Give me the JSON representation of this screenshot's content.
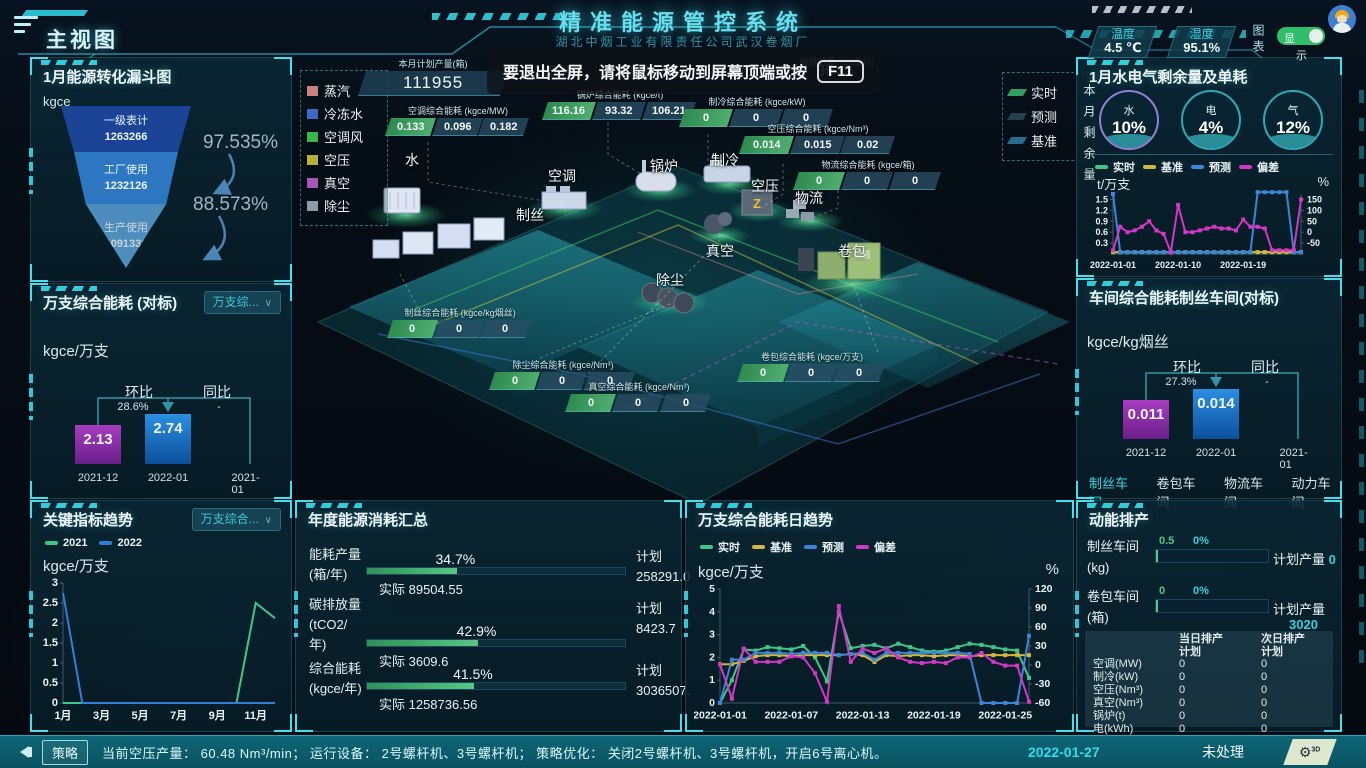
{
  "header": {
    "view_title": "主视图",
    "app_title": "精准能源管控系统",
    "app_subtitle": "湖北中烟工业有限责任公司武汉卷烟厂",
    "temperature_label": "温度",
    "temperature_value": "4.5 ℃",
    "humidity_label": "湿度",
    "humidity_value": "95.1%",
    "chart_vertical_label": "图表",
    "display_toggle_on": "显",
    "display_toggle_off": "示"
  },
  "toast": {
    "message": "要退出全屏，请将鼠标移动到屏幕顶端或按",
    "key": "F11"
  },
  "kpi_band": {
    "plan_label": "本月计划产量(箱)",
    "plan_value": "111955",
    "dim_values": [
      "110961",
      "0.886 %",
      "2.305",
      "3642"
    ],
    "dim_label": "碳排放量(tCO2/月)"
  },
  "scene": {
    "flow_legend": [
      {
        "label": "蒸汽",
        "color": "#c98080"
      },
      {
        "label": "冷冻水",
        "color": "#3f68c9"
      },
      {
        "label": "空调风",
        "color": "#3ab54e"
      },
      {
        "label": "空压",
        "color": "#b8b03a"
      },
      {
        "label": "真空",
        "color": "#a855b8"
      },
      {
        "label": "除尘",
        "color": "#8c9aa8"
      }
    ],
    "series_legend": [
      {
        "label": "实时",
        "color": "#2f9e5f"
      },
      {
        "label": "预测",
        "color": "#24404f"
      },
      {
        "label": "基准",
        "color": "#2a6a8a"
      }
    ],
    "nodes": [
      "水",
      "空调",
      "制丝",
      "锅炉",
      "制冷",
      "空压",
      "物流",
      "真空",
      "除尘",
      "卷包"
    ],
    "strips": [
      {
        "label": "空调综合能耗 (kgce/MW)",
        "values": [
          "0.133",
          "0.096",
          "0.182"
        ]
      },
      {
        "label": "锅炉综合能耗 (kgce/t)",
        "values": [
          "116.16",
          "93.32",
          "106.21"
        ]
      },
      {
        "label": "制冷综合能耗 (kgce/kW)",
        "values": [
          "0",
          "0",
          "0"
        ]
      },
      {
        "label": "空压综合能耗 (kgce/Nm³)",
        "values": [
          "0.014",
          "0.015",
          "0.02"
        ]
      },
      {
        "label": "物流综合能耗 (kgce/箱)",
        "values": [
          "0",
          "0",
          "0"
        ]
      },
      {
        "label": "制丝综合能耗 (kgce/kg烟丝)",
        "values": [
          "0",
          "0",
          "0"
        ]
      },
      {
        "label": "除尘综合能耗 (kgce/Nm³)",
        "values": [
          "0",
          "0",
          "0"
        ]
      },
      {
        "label": "真空综合能耗 (kgce/Nm³)",
        "values": [
          "0",
          "0",
          "0"
        ]
      },
      {
        "label": "卷包综合能耗 (kgce/万支)",
        "values": [
          "0",
          "0",
          "0"
        ]
      }
    ]
  },
  "funnel_panel": {
    "title": "1月能源转化漏斗图",
    "unit": "kgce"
  },
  "wan_panel": {
    "title": "万支综合能耗 (对标)",
    "dropdown": "万支综...",
    "unit": "kgce/万支"
  },
  "trend_panel": {
    "title": "关键指标趋势",
    "dropdown": "万支综合...",
    "unit": "kgce/万支"
  },
  "annual_panel": {
    "title": "年度能源消耗汇总",
    "actual_prefix": "实际",
    "plan_label": "计划",
    "rows": [
      {
        "label_lines": [
          "能耗产量",
          "(箱/年)"
        ],
        "percent": "34.7%",
        "pct": 34.7,
        "actual": "89504.55",
        "plan": "258291.0"
      },
      {
        "label_lines": [
          "碳排放量",
          "(tCO2/",
          "年)"
        ],
        "percent": "42.9%",
        "pct": 42.9,
        "actual": "3609.6",
        "plan": "8423.7"
      },
      {
        "label_lines": [
          "综合能耗",
          "(kgce/年)"
        ],
        "percent": "41.5%",
        "pct": 41.5,
        "actual": "1258736.56",
        "plan": "3036507."
      }
    ]
  },
  "daily_panel": {
    "title": "万支综合能耗日趋势",
    "unit_left": "kgce/万支",
    "unit_right": "%"
  },
  "water_panel": {
    "title": "1月水电气剩余量及单耗",
    "side_label": "本月剩余量",
    "unit_left": "t/万支",
    "unit_right": "%",
    "donuts": [
      {
        "name": "水",
        "pct": "10%",
        "ring": "#8f7fd8"
      },
      {
        "name": "电",
        "pct": "4%",
        "ring": "#2fa8b8"
      },
      {
        "name": "气",
        "pct": "12%",
        "ring": "#2fa8b8"
      }
    ]
  },
  "workshop_panel": {
    "title": "车间综合能耗制丝车间(对标)",
    "unit": "kgce/kg烟丝",
    "tabs": [
      {
        "label": "制丝车间",
        "active": true
      },
      {
        "label": "卷包车间",
        "active": false
      },
      {
        "label": "物流车间",
        "active": false
      },
      {
        "label": "动力车间",
        "active": false
      }
    ]
  },
  "schedule_panel": {
    "title": "动能排产",
    "plan_output_label": "计划产量",
    "rows": [
      {
        "label": "制丝车间",
        "unit": "(kg)",
        "value": "0.5",
        "percent": "0%",
        "plan": "0",
        "plan_inline": true
      },
      {
        "label": "卷包车间",
        "unit": "(箱)",
        "value": "0",
        "percent": "0%",
        "plan": "3020",
        "plan_inline": false
      }
    ],
    "table": {
      "col1": "当日排产",
      "col2": "次日排产",
      "col_sub": "计划",
      "rows": [
        [
          "空调(MW)",
          "0",
          "0"
        ],
        [
          "制冷(kW)",
          "0",
          "0"
        ],
        [
          "空压(Nm³)",
          "0",
          "0"
        ],
        [
          "真空(Nm³)",
          "0",
          "0"
        ],
        [
          "锅炉(t)",
          "0",
          "0"
        ],
        [
          "电(kWh)",
          "0",
          "0"
        ]
      ]
    }
  },
  "status_bar": {
    "badge": "策略",
    "text": "当前空压产量： 60.48 Nm³/min； 运行设备： 2号螺杆机、3号螺杆机； 策略优化： 关闭2号螺杆机、3号螺杆机，开启6号离心机。",
    "date": "2022-01-27",
    "state": "未处理"
  },
  "chart_data": [
    {
      "id": "funnel",
      "type": "funnel",
      "title": "1月能源转化漏斗图",
      "unit": "kgce",
      "stages": [
        {
          "label": "一级表计",
          "value": 1263266,
          "color": "#1c4496"
        },
        {
          "label": "工厂使用",
          "value": 1232126,
          "color": "#2d77c2"
        },
        {
          "label": "生产使用",
          "value": 1091331,
          "color": "#5aa2d8"
        }
      ],
      "conversion_rates": [
        "97.535%",
        "88.573%"
      ]
    },
    {
      "id": "wan-benchmark",
      "type": "bar",
      "unit": "kgce/万支",
      "categories": [
        "2021-12",
        "2022-01",
        "2021-01"
      ],
      "values": [
        2.13,
        2.74,
        null
      ],
      "mom_label": "环比",
      "mom": "28.6%",
      "yoy_label": "同比",
      "yoy": "-",
      "bar_colors": [
        "linear-gradient(180deg,#a73cc2,#6b1f8a)",
        "linear-gradient(180deg,#2b8fe0,#0c4f9c)"
      ]
    },
    {
      "id": "key-trend",
      "type": "line",
      "unit": "kgce/万支",
      "x": [
        "1月",
        "2月",
        "3月",
        "4月",
        "5月",
        "6月",
        "7月",
        "8月",
        "9月",
        "10月",
        "11月",
        "12月"
      ],
      "ylim": [
        0,
        3
      ],
      "yticks": [
        0,
        0.5,
        1,
        1.5,
        2,
        2.5,
        3
      ],
      "xtick_idx": [
        0,
        2,
        4,
        6,
        8,
        10
      ],
      "series": [
        {
          "name": "2021",
          "color": "#3ec787",
          "values": [
            0,
            0,
            0,
            0,
            0,
            0,
            0,
            0,
            0,
            0,
            2.5,
            2.12
          ]
        },
        {
          "name": "2022",
          "color": "#2f7fd9",
          "values": [
            2.75,
            0,
            0,
            0,
            0,
            0,
            0,
            0,
            0,
            0,
            0,
            0
          ]
        }
      ]
    },
    {
      "id": "water-daily",
      "type": "line",
      "unit_left": "t/万支",
      "unit_right": "%",
      "ylim": [
        0,
        1.65
      ],
      "yticks": [
        0.3,
        0.6,
        0.9,
        1.2,
        1.5
      ],
      "y2lim": [
        -100,
        175
      ],
      "y2ticks": [
        -50,
        0,
        50,
        100,
        150
      ],
      "xticks": [
        {
          "i": 0,
          "label": "2022-01-01"
        },
        {
          "i": 9,
          "label": "2022-01-10"
        },
        {
          "i": 18,
          "label": "2022-01-19"
        }
      ],
      "series": [
        {
          "name": "实时",
          "color": "#3ec787",
          "axis": 1,
          "values": [
            0.05,
            0.05,
            0.05,
            0.05,
            0.05,
            0.05,
            0.05,
            0.05,
            0.05,
            0.05,
            0.05,
            0.05,
            0.05,
            0.05,
            0.05,
            0.05,
            0.05,
            0.05,
            0.05,
            0.05,
            0.05,
            0.05,
            0.05,
            0.05,
            0.05,
            0.05,
            0.05
          ]
        },
        {
          "name": "基准",
          "color": "#d4b83a",
          "axis": 1,
          "values": [
            0.05,
            0.05,
            0.05,
            0.05,
            0.05,
            0.05,
            0.05,
            0.05,
            0.05,
            0.05,
            0.05,
            0.05,
            0.05,
            0.05,
            0.05,
            0.05,
            0.05,
            0.05,
            0.05,
            0.05,
            0.05,
            0.05,
            0.05,
            0.05,
            0.05,
            0.05,
            0.05
          ]
        },
        {
          "name": "预测",
          "color": "#3a86d9",
          "axis": 1,
          "values": [
            1.65,
            0.05,
            0.05,
            0.05,
            0.05,
            0.05,
            0.05,
            0.05,
            0.05,
            0.05,
            0.05,
            0.05,
            0.05,
            0.05,
            0.05,
            0.05,
            0.05,
            0.05,
            0.05,
            0.05,
            1.7,
            1.7,
            1.7,
            1.7,
            1.7,
            0.05,
            0.05
          ]
        },
        {
          "name": "偏差",
          "color": "#d337c5",
          "axis": 2,
          "values": [
            -83,
            25,
            0,
            8,
            25,
            50,
            8,
            -8,
            -92,
            125,
            0,
            0,
            8,
            17,
            25,
            17,
            17,
            8,
            58,
            25,
            25,
            17,
            -83,
            -83,
            -83,
            -83,
            150
          ]
        }
      ]
    },
    {
      "id": "wan-daily",
      "type": "line",
      "unit_left": "kgce/万支",
      "unit_right": "%",
      "ylim": [
        0,
        5
      ],
      "yticks": [
        0,
        1,
        2,
        3,
        4,
        5
      ],
      "y2lim": [
        -60,
        120
      ],
      "y2ticks": [
        -60,
        -30,
        0,
        30,
        60,
        90,
        120
      ],
      "xticks": [
        {
          "i": 0,
          "label": "2022-01-01"
        },
        {
          "i": 6,
          "label": "2022-01-07"
        },
        {
          "i": 12,
          "label": "2022-01-13"
        },
        {
          "i": 18,
          "label": "2022-01-19"
        },
        {
          "i": 24,
          "label": "2022-01-25"
        }
      ],
      "series": [
        {
          "name": "实时",
          "color": "#3ec787",
          "axis": 1,
          "values": [
            0,
            1.0,
            2.35,
            2.3,
            2.45,
            2.4,
            2.35,
            2.5,
            2.0,
            0.95,
            4.0,
            2.4,
            2.5,
            2.55,
            2.4,
            2.6,
            2.45,
            2.3,
            2.25,
            2.3,
            2.45,
            2.6,
            2.55,
            2.45,
            2.35,
            2.3,
            1.1
          ]
        },
        {
          "name": "基准",
          "color": "#d4b83a",
          "axis": 1,
          "values": [
            1.7,
            1.7,
            1.85,
            2.05,
            2.1,
            2.1,
            2.05,
            2.1,
            2.1,
            2.1,
            2.1,
            2.15,
            2.1,
            1.8,
            2.1,
            2.05,
            2.1,
            2.1,
            2.05,
            2.1,
            2.1,
            2.05,
            2.1,
            2.1,
            2.1,
            2.1,
            2.1
          ]
        },
        {
          "name": "预测",
          "color": "#3a86d9",
          "axis": 1,
          "values": [
            0,
            1.9,
            1.9,
            2.2,
            2.2,
            2.2,
            2.15,
            2.2,
            2.2,
            2.2,
            2.1,
            2.15,
            2.2,
            1.9,
            2.2,
            2.2,
            2.2,
            2.2,
            2.2,
            2.2,
            2.2,
            2.15,
            0,
            0,
            0,
            0,
            2.95
          ]
        },
        {
          "name": "偏差",
          "color": "#d337c5",
          "axis": 2,
          "values": [
            1,
            -53,
            26,
            5,
            5,
            5,
            14,
            12,
            -13,
            -58,
            93,
            5,
            26,
            19,
            26,
            12,
            5,
            3,
            5,
            3,
            12,
            12,
            19,
            5,
            -1,
            -1,
            -58
          ]
        }
      ]
    },
    {
      "id": "workshop-benchmark",
      "type": "bar",
      "unit": "kgce/kg烟丝",
      "categories": [
        "2021-12",
        "2022-01",
        "2021-01"
      ],
      "values": [
        0.011,
        0.014,
        null
      ],
      "mom_label": "环比",
      "mom": "27.3%",
      "yoy_label": "同比",
      "yoy": "-",
      "bar_colors": [
        "linear-gradient(180deg,#a73cc2,#6b1f8a)",
        "linear-gradient(180deg,#2b8fe0,#0c4f9c)"
      ]
    }
  ]
}
